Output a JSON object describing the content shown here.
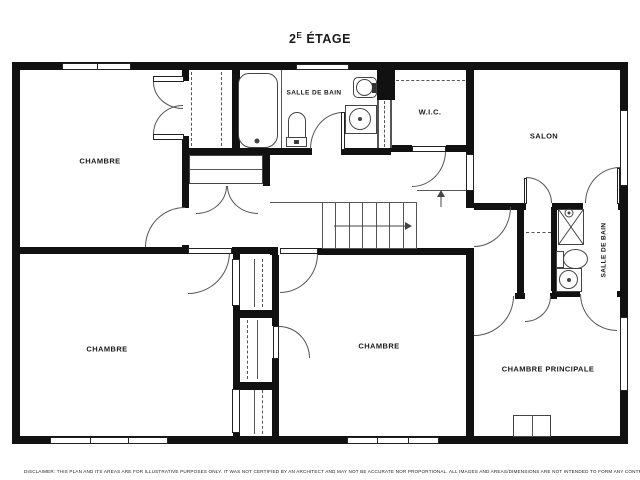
{
  "title": {
    "number": "2",
    "sup": "E",
    "word": "ÉTAGE"
  },
  "rooms": [
    {
      "id": "bedroom-top-left",
      "label": "CHAMBRE"
    },
    {
      "id": "bathroom-main",
      "label": "SALLE DE BAIN"
    },
    {
      "id": "walk-in-closet",
      "label": "W.I.C."
    },
    {
      "id": "living-room",
      "label": "SALON"
    },
    {
      "id": "bedroom-bottom-left",
      "label": "CHAMBRE"
    },
    {
      "id": "bedroom-middle",
      "label": "CHAMBRE"
    },
    {
      "id": "master-bedroom",
      "label": "CHAMBRE PRINCIPALE"
    },
    {
      "id": "bathroom-ensuite",
      "label": "SALLE DE BAIN"
    }
  ],
  "disclaimer": "DISCLAIMER: THIS PLAN AND ITS AREAS ARE FOR ILLUSTRATIVE PURPOSES ONLY. IT WAS NOT CERTIFIED BY AN ARCHITECT AND MAY NOT BE ACCURATE NOR PROPORTIONAL. ALL IMAGES AND AREAS/DIMENSIONS ARE NOT INTENDED TO FORM ANY CONTRACT OR WARRANTY.",
  "colors": {
    "wall": "#111111",
    "thin_line": "#555555",
    "background": "#ffffff",
    "text": "#1a1a1a"
  }
}
